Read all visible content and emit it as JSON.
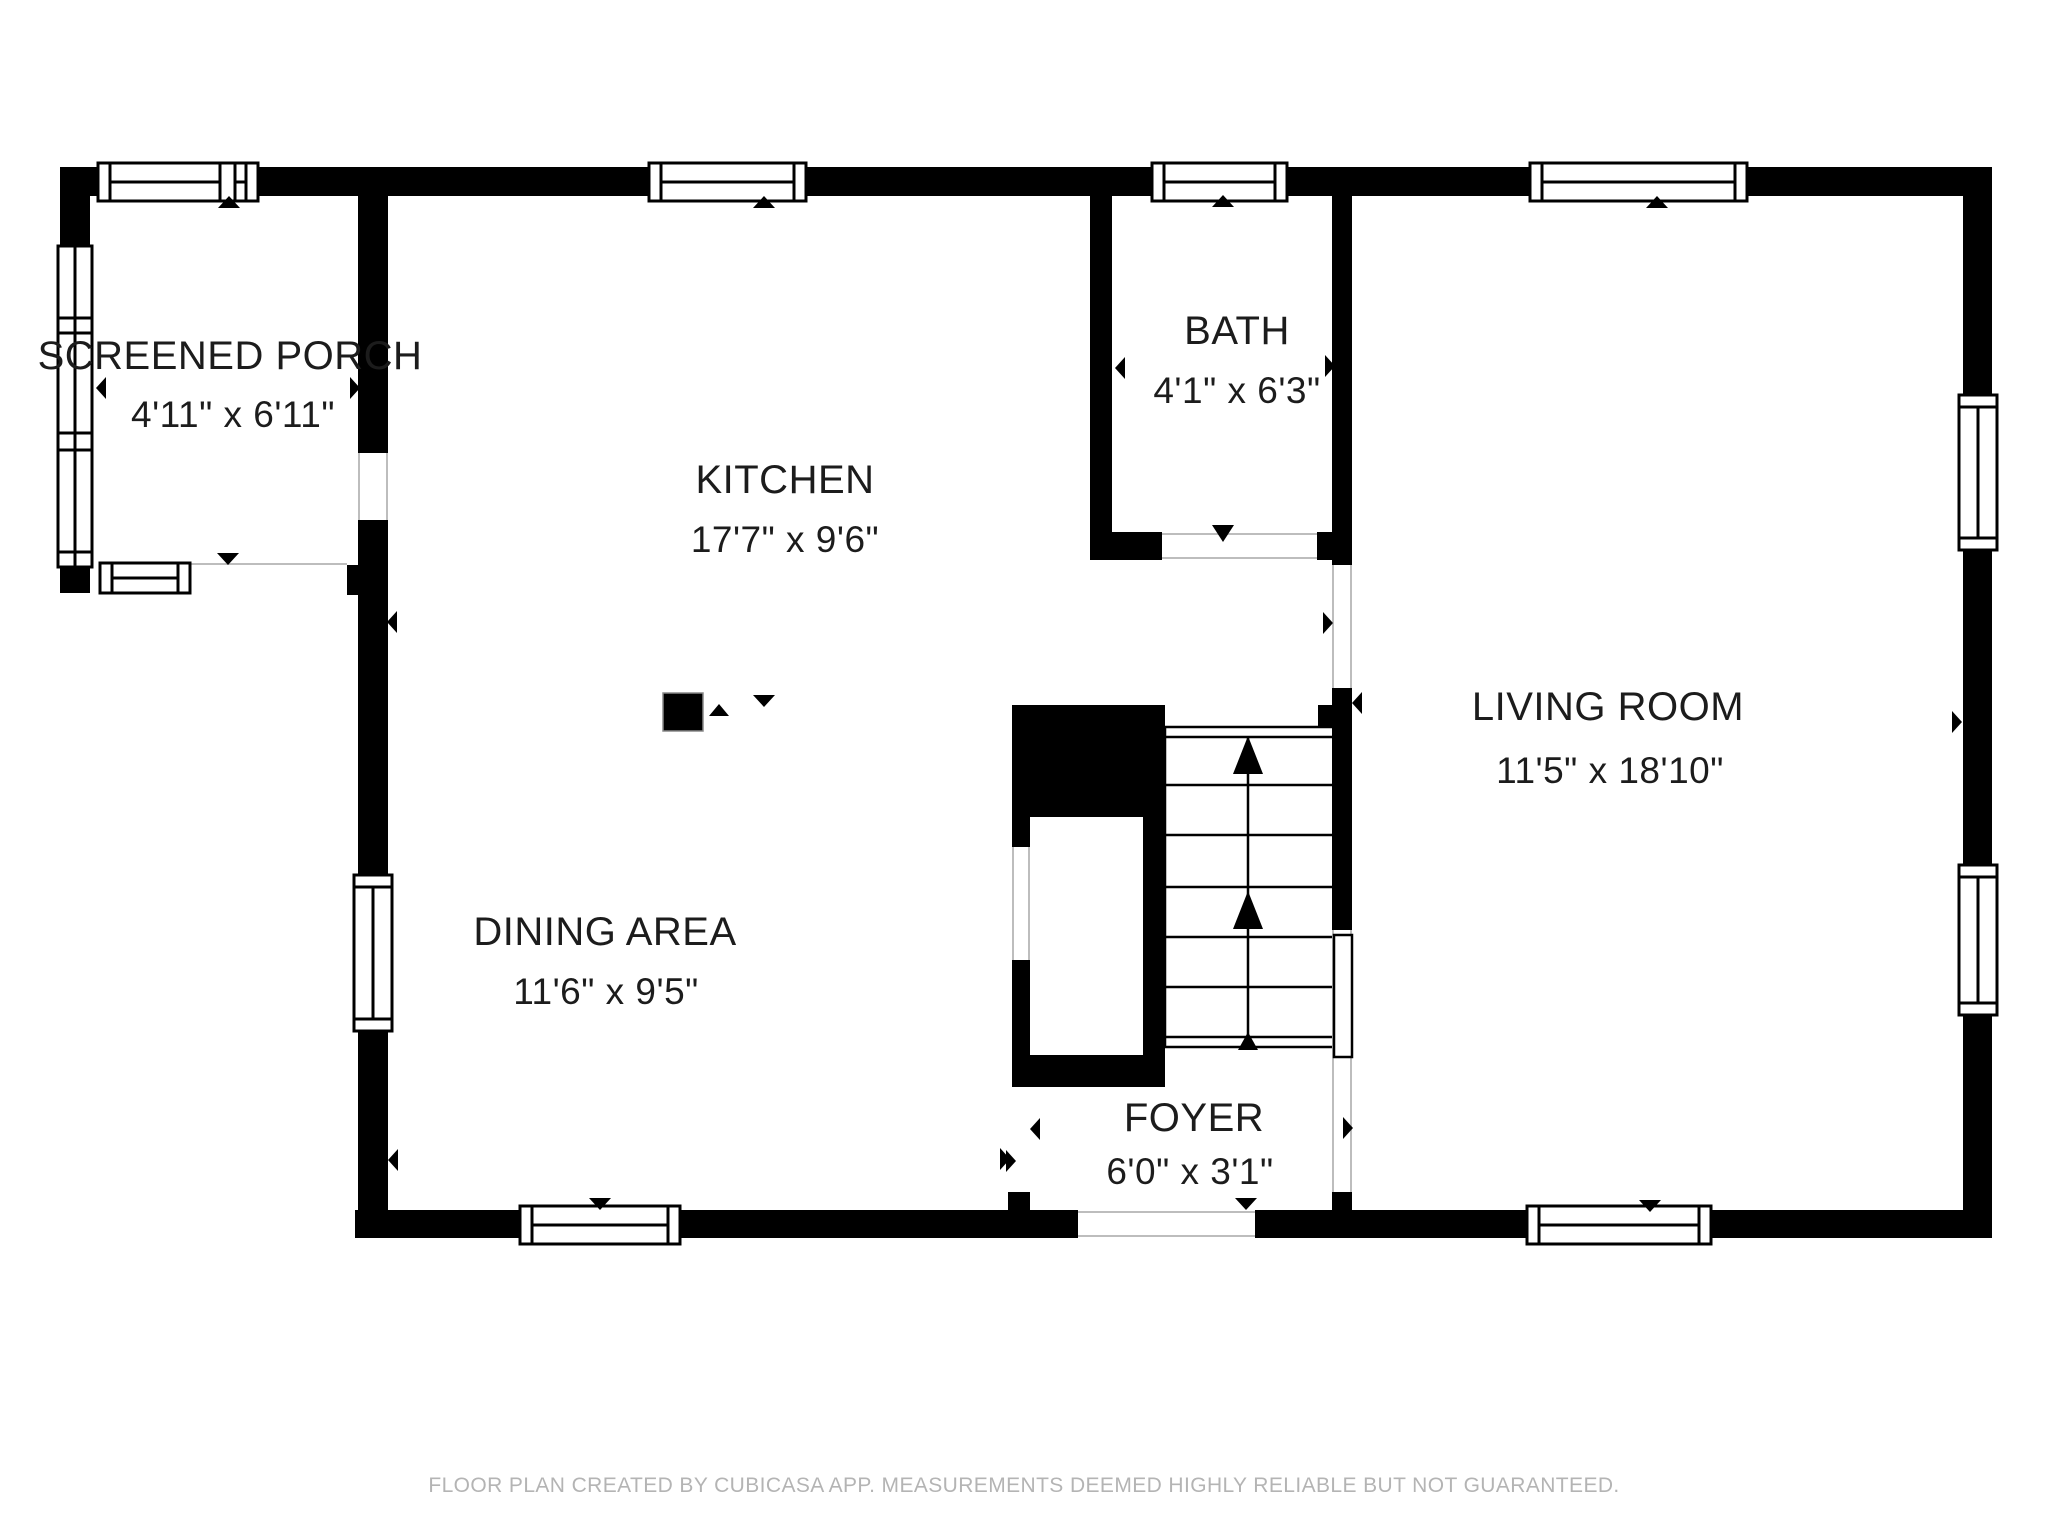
{
  "rooms": [
    {
      "name": "SCREENED PORCH",
      "dimensions": "4'11\" x 6'11\""
    },
    {
      "name": "KITCHEN",
      "dimensions": "17'7\" x 9'6\""
    },
    {
      "name": "BATH",
      "dimensions": "4'1\" x 6'3\""
    },
    {
      "name": "LIVING ROOM",
      "dimensions": "11'5\" x 18'10\""
    },
    {
      "name": "DINING AREA",
      "dimensions": "11'6\" x 9'5\""
    },
    {
      "name": "FOYER",
      "dimensions": "6'0\" x 3'1\""
    }
  ],
  "footer": {
    "disclaimer": "FLOOR PLAN CREATED BY CUBICASA APP. MEASUREMENTS DEEMED HIGHLY RELIABLE BUT NOT GUARANTEED."
  },
  "icons": {
    "window-marker-up": "▲",
    "window-marker-down": "▼",
    "span-marker-left": "◄",
    "span-marker-right": "►",
    "stair-direction-arrow": "▲"
  },
  "colors": {
    "wall": "#000000",
    "label_text": "#1c1c1c",
    "footer_text": "#b4b4b4",
    "background": "#ffffff",
    "opening_line": "#bdbdbd"
  }
}
